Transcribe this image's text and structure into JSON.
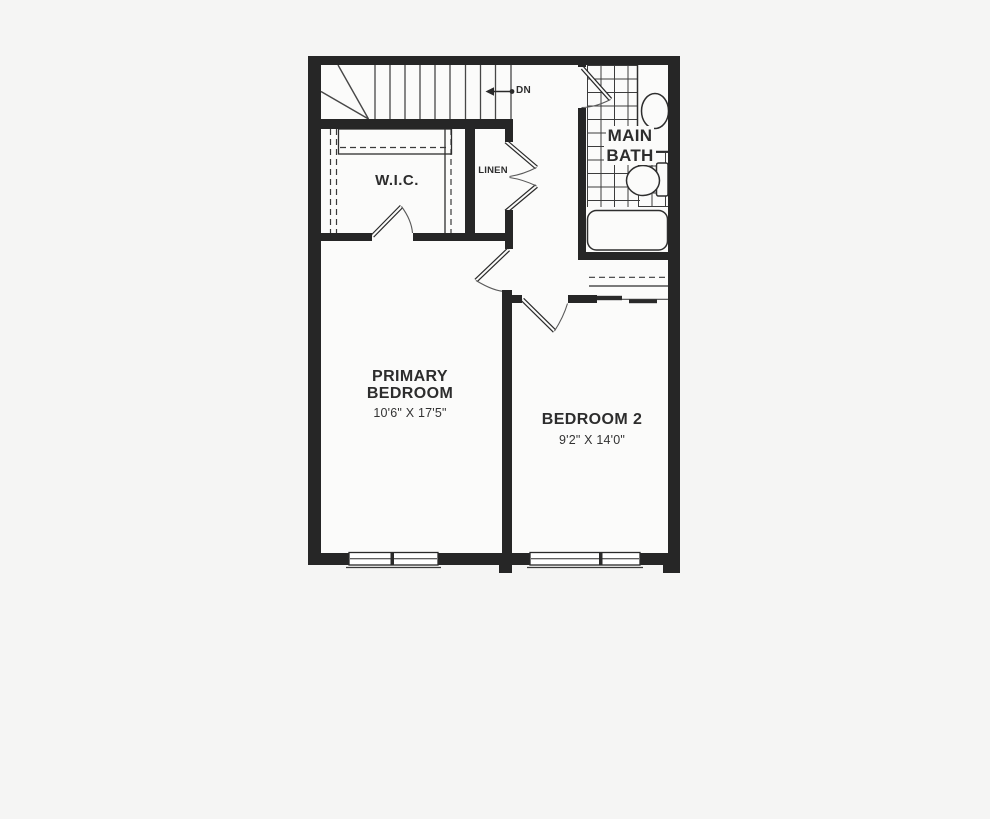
{
  "floorplan": {
    "stairs": {
      "direction_label": "DN"
    },
    "rooms": {
      "wic": {
        "label": "W.I.C."
      },
      "linen": {
        "label": "LINEN"
      },
      "main_bath": {
        "label_line1": "MAIN",
        "label_line2": "BATH"
      },
      "primary_bedroom": {
        "label_line1": "PRIMARY",
        "label_line2": "BEDROOM",
        "dimensions": "10'6\" X 17'5\""
      },
      "bedroom_2": {
        "label": "BEDROOM 2",
        "dimensions": "9'2\" X 14'0\""
      }
    },
    "colors": {
      "wall": "#262626",
      "line": "#2e2e2e",
      "floor": "#fbfbfa",
      "background": "#f5f5f4",
      "text": "#2d2d2d"
    }
  }
}
